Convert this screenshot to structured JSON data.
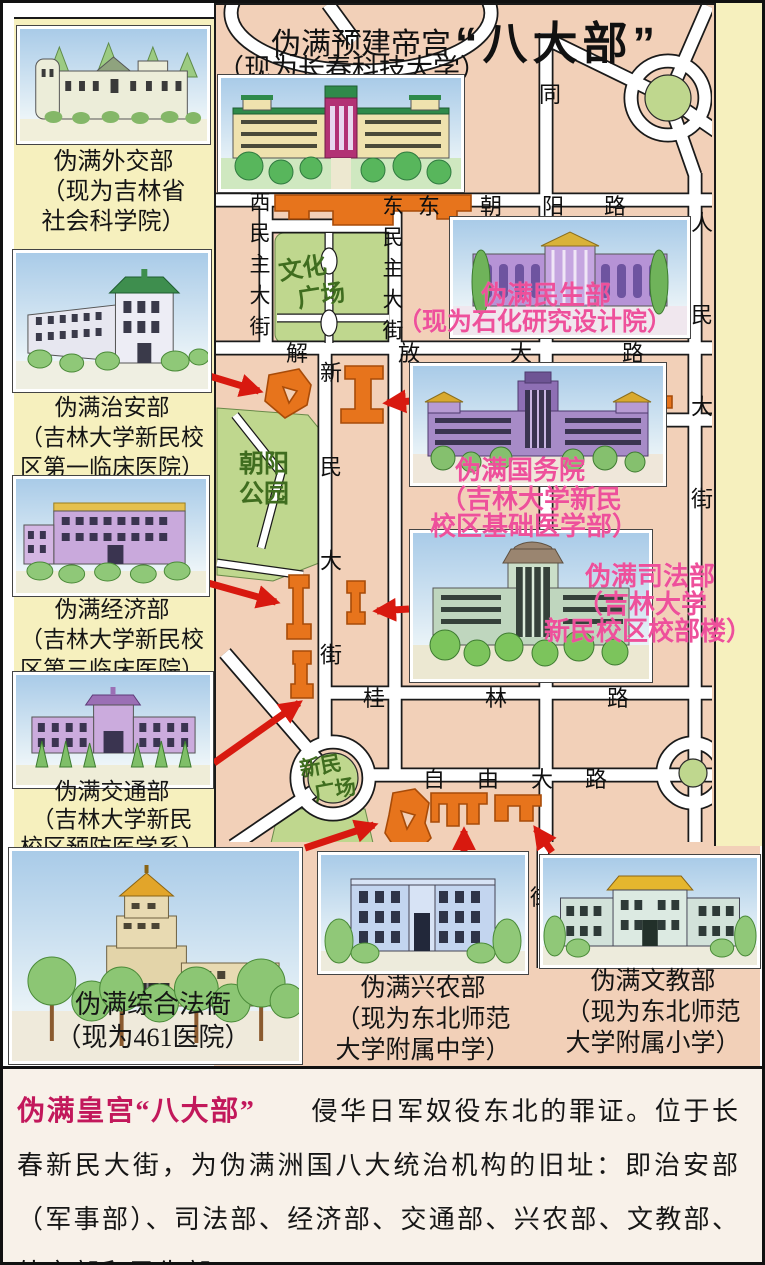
{
  "title": {
    "main": "“八大部”",
    "palace_line1": "伪满预建帝宫",
    "palace_line2": "（现为长春科技大学）"
  },
  "sidebar": {
    "cards": [
      {
        "name": "伪满外交部",
        "sub1": "（现为吉林省",
        "sub2": "社会科学院）"
      },
      {
        "name": "伪满治安部",
        "sub1": "（吉林大学新民校",
        "sub2": "区第一临床医院）"
      },
      {
        "name": "伪满经济部",
        "sub1": "（吉林大学新民校",
        "sub2": "区第三临床医院）"
      },
      {
        "name": "伪满交通部",
        "sub1": "（吉林大学新民",
        "sub2": "校区预防医学系）"
      }
    ]
  },
  "bottom_cards": [
    {
      "name": "伪满综合法衙",
      "sub1": "（现为461医院）",
      "sub2": ""
    },
    {
      "name": "伪满兴农部",
      "sub1": "（现为东北师范",
      "sub2": "大学附属中学）"
    },
    {
      "name": "伪满文教部",
      "sub1": "（现为东北师范",
      "sub2": "大学附属小学）"
    }
  ],
  "map": {
    "streets": {
      "dongchaoyang": "东朝阳路",
      "jiefang": "解放大路",
      "guilin": "桂林路",
      "ziyou": "自由大路",
      "ximinzhu": "西民主大街",
      "dongminzhu": "东民主大街",
      "xinmin": "新民大街",
      "renmin": "人民大街",
      "tongzhi_char": "同",
      "jie_char": "街"
    },
    "places": {
      "wenhua_l1": "文化",
      "wenhua_l2": "广场",
      "chaoyang_l1": "朝阳",
      "chaoyang_l2": "公园",
      "xinminsq_l1": "新民",
      "xinminsq_l2": "广场"
    },
    "insets": {
      "minsheng": {
        "l1": "伪满民生部",
        "l2": "（现为石化研究设计院）"
      },
      "guowuyuan": {
        "l1": "伪满国务院",
        "l2": "（吉林大学新民",
        "l3": "校区基础医学部）"
      },
      "sifa": {
        "l1": "伪满司法部",
        "l2": "（吉林大学",
        "l3": "新民校区校部楼）"
      }
    }
  },
  "caption": {
    "heading": "伪满皇宫“八大部”",
    "body": "侵华日军奴役东北的罪证。位于长春新民大街，为伪满洲国八大统治机构的旧址：即治安部（军事部）、司法部、经济部、交通部、兴农部、文教部、外交部和民生部。"
  },
  "colors": {
    "map_bg": "#F2D0B8",
    "sidebar_bg": "#F6F0BE",
    "park_green": "#BFD78E",
    "footprint_orange": "#E7741C",
    "arrow_red": "#D8190F",
    "label_pink": "#EE509B",
    "park_text_green": "#3F6D1F",
    "caption_heading_magenta": "#C2185B"
  }
}
